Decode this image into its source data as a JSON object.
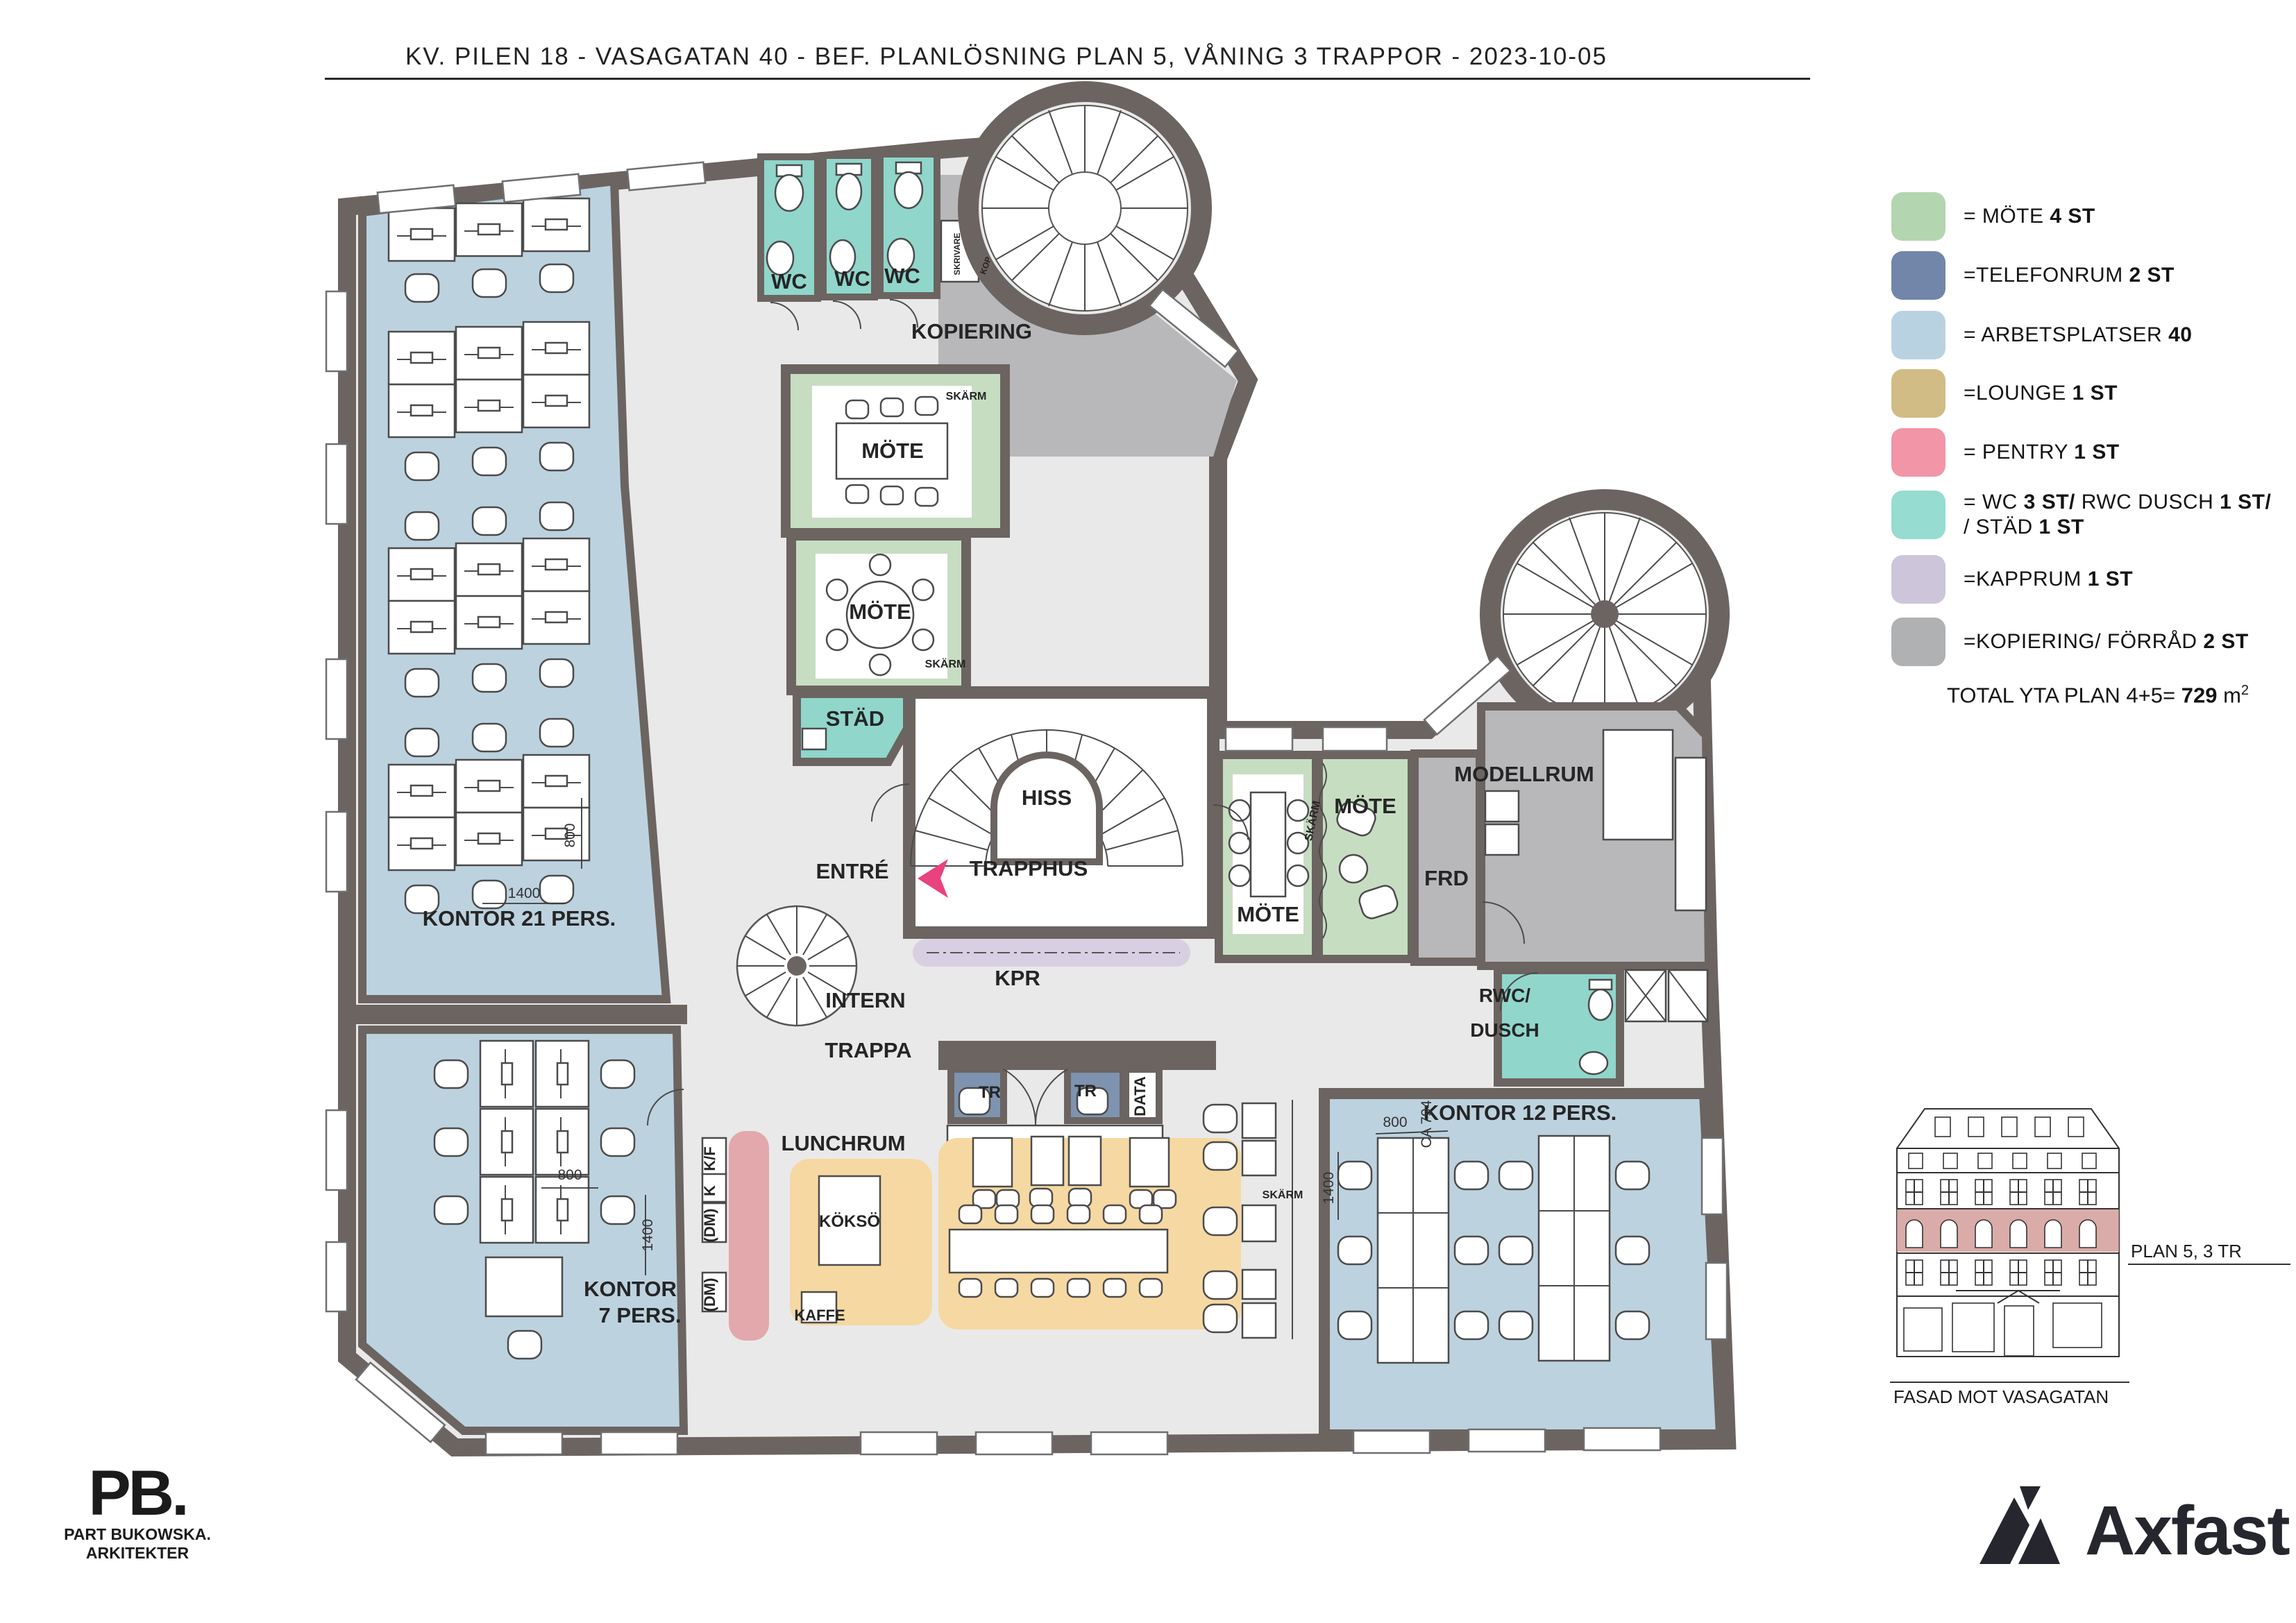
{
  "title": "KV. PILEN 18 -  VASAGATAN 40  -  BEF. PLANLÖSNING PLAN 5, VÅNING 3 TRAPPOR   -   2023-10-05",
  "legend": {
    "items": [
      {
        "color": "#b3d5b0",
        "pre": "= MÖTE ",
        "bold": "4 ST"
      },
      {
        "color": "#7186a9",
        "pre": "=TELEFONRUM ",
        "bold": "2 ST"
      },
      {
        "color": "#b9d2e2",
        "pre": "= ARBETSPLATSER ",
        "bold": "40"
      },
      {
        "color": "#d2bc85",
        "pre": "=LOUNGE ",
        "bold": "1 ST"
      },
      {
        "color": "#f295a7",
        "pre": "= PENTRY ",
        "bold": "1 ST"
      },
      {
        "color": "#96dcd1",
        "pre": "= WC ",
        "bold": "3 ST/",
        "mid": " RWC DUSCH ",
        "bold2": "1 ST/",
        "line2_pre": "/ STÄD ",
        "line2_bold": "1 ST"
      },
      {
        "color": "#cdc5d9",
        "pre": "=KAPPRUM ",
        "bold": "1 ST"
      },
      {
        "color": "#b0b1b3",
        "pre": "=KOPIERING/ FÖRRÅD ",
        "bold": "2 ST"
      }
    ]
  },
  "total": {
    "pre": "TOTAL YTA PLAN 4+5= ",
    "bold": "729",
    "post": " m"
  },
  "plan": {
    "wc1": "WC",
    "wc2": "WC",
    "wc3": "WC",
    "kopiering": "KOPIERING",
    "skrivare": "SKRIVARE",
    "kop": "KOP",
    "skarm1": "SKÄRM",
    "skarm2": "SKÄRM",
    "skarm3": "SKÄRM",
    "skarm4": "SKÄRM",
    "mote1": "MÖTE",
    "mote2": "MÖTE",
    "mote3": "MÖTE",
    "mote4": "MÖTE",
    "stad": "STÄD",
    "hiss": "HISS",
    "trapphus": "TRAPPHUS",
    "entre": "ENTRÉ",
    "kpr": "KPR",
    "intern_line1": "INTERN",
    "intern_line2": "TRAPPA",
    "kontor21": "KONTOR 21 PERS.",
    "kontor7_line1": "KONTOR",
    "kontor7_line2": "7 PERS.",
    "kontor12": "KONTOR 12 PERS.",
    "tr1": "TR",
    "tr2": "TR",
    "data": "DATA",
    "lunchrum": "LUNCHRUM",
    "kokso": "KÖKSÖ",
    "kaffe": "KAFFE",
    "kf": "K/F",
    "k": "K",
    "dm1": "(DM)",
    "dm2": "(DM)",
    "frd": "FRD",
    "modellrum": "MODELLRUM",
    "rwc_line1": "RWC/",
    "rwc_line2": "DUSCH"
  },
  "dims": {
    "a1400": "1400",
    "a800": "800",
    "b800": "800",
    "b1400": "1400",
    "c800": "800",
    "c794": "CA 794",
    "c1400": "1400"
  },
  "facade": {
    "plan_label": "PLAN 5, 3 TR",
    "caption": "FASAD MOT VASAGATAN"
  },
  "pb": {
    "mark": "PB.",
    "line1": "PART BUKOWSKA.",
    "line2": "ARKITEKTER"
  },
  "axfast": {
    "name": "Axfast"
  }
}
